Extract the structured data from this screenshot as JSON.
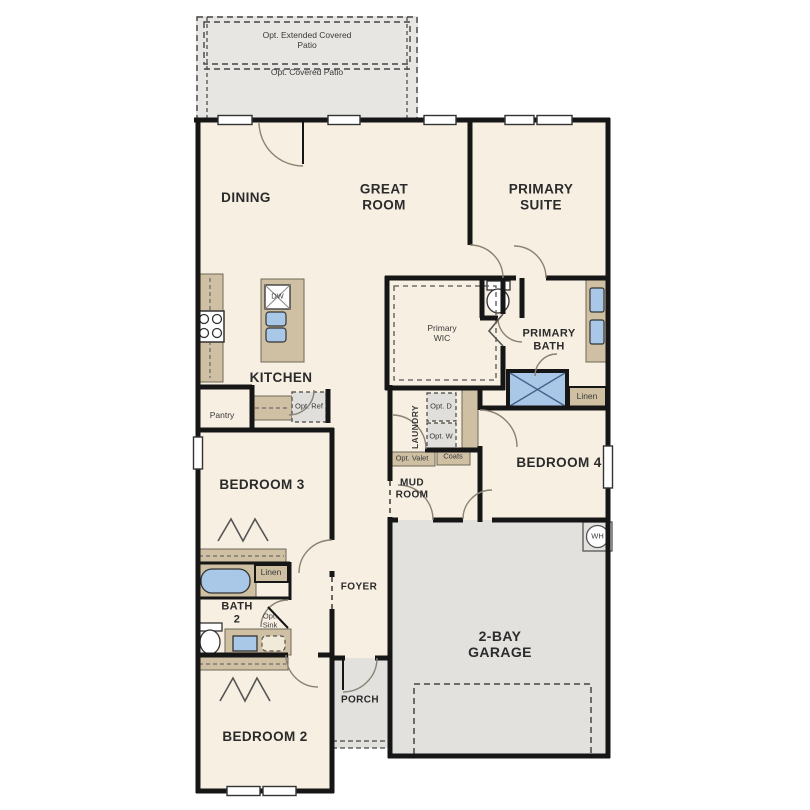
{
  "plan": {
    "name": "Single-story floor plan",
    "colors": {
      "floor": "#f7efe2",
      "concrete": "#e4e3e0",
      "cabinet_tan": "#cfc0a3",
      "fixture_blue": "#a9c8e7",
      "wall": "#161616"
    },
    "labels": {
      "patio_extended": "Opt. Extended Covered Patio",
      "patio_covered": "Opt. Covered Patio",
      "dining": "DINING",
      "great_room": "GREAT ROOM",
      "primary_suite": "PRIMARY SUITE",
      "kitchen": "KITCHEN",
      "dw": "DW",
      "pantry": "Pantry",
      "opt_ref": "Opt. Ref",
      "primary_wic": "Primary WIC",
      "primary_bath": "PRIMARY BATH",
      "linen_primary": "Linen",
      "laundry": "LAUNDRY",
      "opt_d": "Opt. D",
      "opt_w": "Opt. W",
      "opt_valet": "Opt. Valet",
      "coats": "Coats",
      "mud_room": "MUD ROOM",
      "bedroom_4": "BEDROOM 4",
      "bedroom_3": "BEDROOM 3",
      "linen_bath2": "Linen",
      "bath_2": "BATH 2",
      "opt_sink": "Opt. Sink",
      "foyer": "FOYER",
      "porch": "PORCH",
      "bedroom_2": "BEDROOM 2",
      "garage": "2-BAY GARAGE",
      "water_heater": "WH"
    }
  }
}
